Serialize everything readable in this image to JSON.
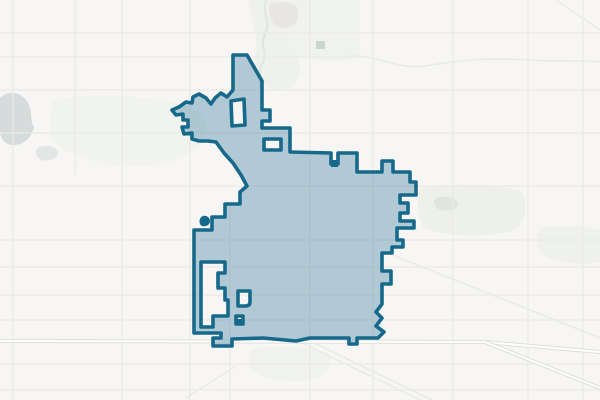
{
  "map": {
    "colors": {
      "background": "#f7f6f4",
      "road_minor": "#eaeae6",
      "road_major_casing": "#dcdcd8",
      "road_major_fill": "#fdfdfb",
      "water": "#d6dbdc",
      "stream": "#dfe6e2",
      "boundary_stroke": "#17698c",
      "boundary_fill": "#4f8ba6",
      "boundary_fill_opacity": "0.42"
    },
    "patches": [
      {
        "name": "green-area-west",
        "fill": "#f1f3ee",
        "d": "M55,100 C90,92 150,95 185,105 C210,112 212,135 195,150 C170,168 120,172 90,160 C65,150 48,146 50,128 C51,114 50,104 55,100 Z"
      },
      {
        "name": "green-area-river-north",
        "fill": "#eef1ec",
        "d": "M248,0 L300,0 C305,20 295,45 300,65 C302,80 290,92 275,90 C260,88 252,70 256,50 C258,35 250,15 248,0 Z"
      },
      {
        "name": "green-area-north-center",
        "fill": "#f0f2ee",
        "d": "M285,0 L360,0 L360,58 C335,64 300,60 285,52 Z"
      },
      {
        "name": "green-area-east",
        "fill": "#edf1ea",
        "d": "M422,188 C450,182 500,184 522,192 C530,206 525,226 510,232 C480,238 440,236 424,228 C416,214 416,196 422,188 Z"
      },
      {
        "name": "green-dot-east",
        "fill": "#dfe7dc",
        "d": "M436,198 C444,195 456,197 458,203 C459,209 450,212 441,210 C434,208 432,201 436,198 Z"
      },
      {
        "name": "green-area-far-east",
        "fill": "#eef1ec",
        "d": "M540,228 C560,224 590,226 600,230 L600,262 C580,266 552,262 542,254 C536,246 536,234 540,228 Z"
      },
      {
        "name": "green-area-south",
        "fill": "#f0f2ee",
        "d": "M250,350 C275,344 310,346 330,354 C334,364 328,376 310,380 C285,384 258,378 250,368 Z"
      },
      {
        "name": "urban-area-north",
        "fill": "#e7e6e3",
        "d": "M270,4 C280,0 295,2 298,10 C300,20 294,28 283,28 C272,28 266,12 270,4 Z"
      },
      {
        "name": "green-square-north",
        "fill": "#ccd7cb",
        "d": "M316,41 L325,41 L325,49 L316,49 Z"
      },
      {
        "name": "lake-west",
        "fill": "#d6dbdc",
        "d": "M0,98 C8,90 20,92 26,100 C34,110 29,120 34,127 C31,141 18,148 8,144 C2,141 0,136 0,130 Z"
      },
      {
        "name": "pond-west",
        "fill": "#e2e7e5",
        "d": "M38,148 C46,144 56,146 58,152 C59,158 50,162 42,160 C36,158 34,151 38,148 Z"
      }
    ],
    "streams": [
      {
        "name": "creek-north",
        "d": "M266,0 C261,12 272,22 265,34 C259,46 269,52 262,64 C258,72 262,80 260,88",
        "w": 2
      }
    ],
    "roads": {
      "minor_lines": [
        [
          13,
          0,
          13,
          400
        ],
        [
          75,
          0,
          75,
          175
        ],
        [
          122,
          0,
          122,
          400
        ],
        [
          190,
          0,
          190,
          400
        ],
        [
          230,
          205,
          230,
          400
        ],
        [
          310,
          0,
          310,
          400
        ],
        [
          373,
          0,
          373,
          400
        ],
        [
          453,
          0,
          453,
          400
        ],
        [
          528,
          0,
          528,
          400
        ],
        [
          583,
          0,
          583,
          400
        ],
        [
          0,
          33,
          600,
          33
        ],
        [
          0,
          57,
          345,
          57
        ],
        [
          0,
          90,
          600,
          90
        ],
        [
          0,
          133,
          600,
          133
        ],
        [
          0,
          186,
          600,
          186
        ],
        [
          0,
          240,
          600,
          240
        ],
        [
          0,
          267,
          600,
          267
        ],
        [
          0,
          295,
          600,
          295
        ],
        [
          0,
          320,
          600,
          320
        ],
        [
          0,
          364,
          600,
          364
        ],
        [
          0,
          390,
          600,
          390
        ]
      ],
      "minor_paths": [
        {
          "name": "diagonal-road-se",
          "d": "M385,252 L600,338"
        },
        {
          "name": "diagonal-road-s1",
          "d": "M298,341 L420,400"
        },
        {
          "name": "diagonal-road-s2",
          "d": "M310,341 L432,400"
        },
        {
          "name": "diagonal-road-sw",
          "d": "M186,398 L236,366"
        },
        {
          "name": "diagonal-road-ne",
          "d": "M556,0 L600,30"
        },
        {
          "name": "wavy-road-northeast",
          "d": "M345,57 C375,52 392,70 425,66 C460,61 480,57 530,60 C560,62 580,60 600,62"
        }
      ],
      "major_paths": [
        {
          "name": "highway-south",
          "d": "M0,341 L485,342 L600,352"
        },
        {
          "name": "highway-south-branch",
          "d": "M485,342 L600,388"
        }
      ]
    },
    "boundary": {
      "name": "city-limits",
      "outer": "M233,55 L247,55 L262,81 L262,110 L270,110 L270,121 L262,121 L262,128 L290,128 L290,152 L331,153 L331,164 L338,164 L338,153 L357,153 L357,172 L382,172 L382,161 L393,161 L393,172 L410,172 L410,182 L416,182 L416,195 L400,195 L400,203 L408,203 L408,213 L400,213 L400,221 L414,221 L414,228 L397,228 L397,240 L403,240 L403,247 L392,247 L392,253 L382,253 L382,271 L391,271 L391,284 L382,284 L382,304 L376,312 L382,318 L376,326 L384,332 L378,338 L357,338 L357,344 L349,344 L349,338 L310,338 L296,341 L263,338 L232,339 L232,346 L213,346 L213,338 L221,338 L221,333 L194,333 L194,230 L212,230 L212,217 L225,217 L225,204 L240,204 L240,192 L247,186 L241,175 L233,163 L224,153 L216,142 L208,141 L199,141 L192,139 L192,133 L184,134 L182,127 L188,127 L188,120 L183,120 L183,114 L176,115 L172,110 L179,107 L186,102 L192,103 L193,97 L199,94 L206,98 L211,104 L215,98 L221,93 L227,97 L233,90 Z",
      "holes": [
        "M201,262 L225,262 L225,273 L218,273 L218,288 L225,288 L225,300 L228,300 L228,316 L213,316 L213,327 L201,327 Z",
        "M238,291 L250,291 L250,302 Q250,306 245,306 L238,306 Z",
        "M236,316 L243,316 L243,324 L236,324 Z",
        "M264,139 L281,139 L281,150 L264,150 Z",
        "M231,101 L244,99 L245,125 L232,126 Z"
      ],
      "islands": [
        {
          "name": "boundary-enclave-dot",
          "d": "M203,216 C207,215 210,218 210,221 C210,225 206,227 202,226 C199,225 198,218 203,216 Z"
        },
        {
          "name": "boundary-island-ne-square",
          "d": "M331,160 L338,160 L338,167 L331,167 Z"
        },
        {
          "name": "boundary-island-s-square",
          "d": "M236,319 L242,319 L242,325 L236,325 Z"
        }
      ],
      "stroke_width": 3.6
    }
  }
}
